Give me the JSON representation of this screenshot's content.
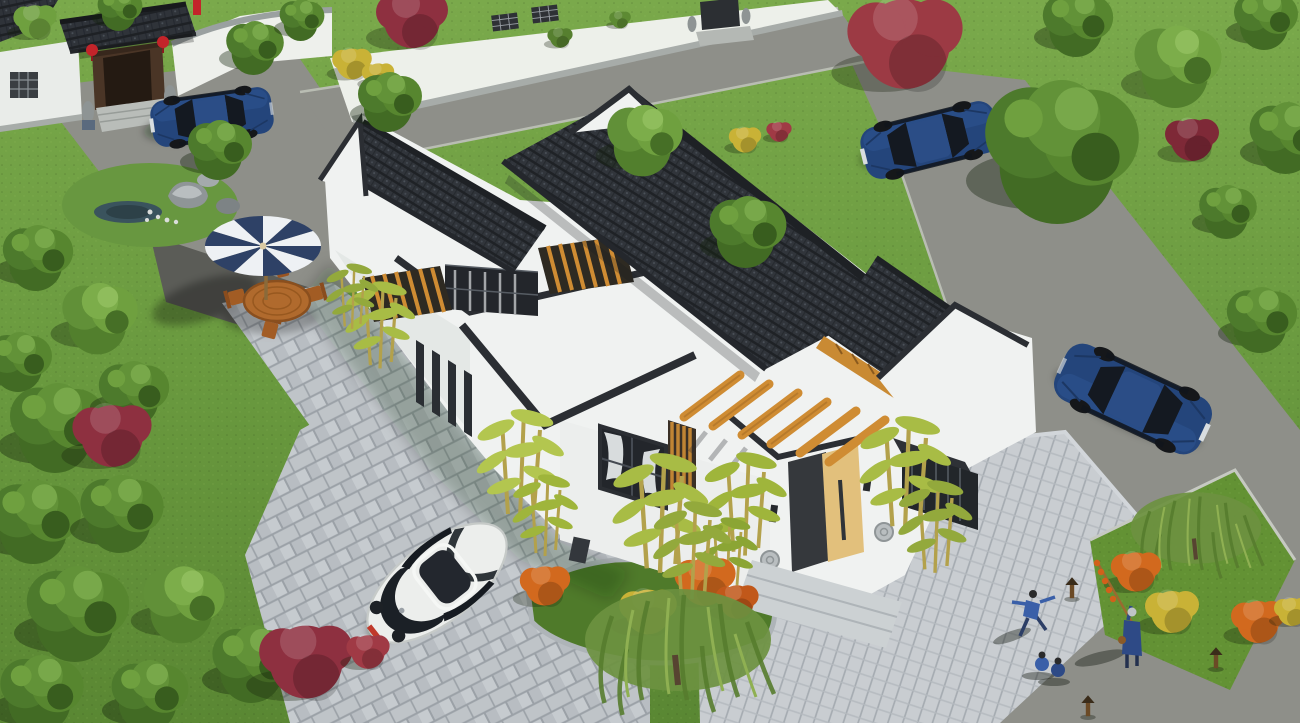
{
  "scene": {
    "type": "3d-architectural-rendering",
    "view": "aerial-isometric",
    "subject": "chinese-style-courtyard-house",
    "setting": "residential compound with lawns, roads, paved courts"
  },
  "palette": {
    "lawn": "#6a9a3f",
    "lawn_dark": "#567f2f",
    "bed": "#4f7a2a",
    "road": "#8e8f89",
    "asphalt": "#5b5c57",
    "paver": "#bcc1c5",
    "paver_light": "#c9cdd0",
    "roof_tile": "#30343a",
    "roof_trim": "#2b2e33",
    "wall": "#f0f2f1",
    "wall_shade": "#e2e6e4",
    "wood": "#c98a33",
    "door": "#e2c07c",
    "stone": "#ccd1d3",
    "water": "#3a535d",
    "umbrella_navy": "#2e4166",
    "umbrella_white": "#eef1f4",
    "car_blue": "#27497f",
    "car_white": "#eceeec",
    "plate_red": "#c0392b",
    "tree": "#4d7a2c",
    "tree_light": "#6fa03f",
    "foliage_red": "#8e3040",
    "foliage_red2": "#9c3a44",
    "flower_orange": "#d2691e",
    "flower_yellow": "#c9b236",
    "lantern_red": "#c3242a",
    "clothing_blue": "#3a5fa8",
    "clothing_navy": "#2e4a86"
  },
  "objects": {
    "main_house": {
      "style": "modern-chinese-courtyard",
      "roof": "dark-grey-tile-gable",
      "walls": "white",
      "accents": "timber-pergola-beams",
      "door": "light-timber",
      "features": [
        "flat-roof-sections",
        "curtained-window",
        "timber-slat-screen",
        "lattice-courtyard-windows",
        "stone-drum-doorsteps",
        "bamboo-planting"
      ]
    },
    "gatehouse": {
      "style": "traditional-gate",
      "features": [
        "dark-tile-roof",
        "red-lanterns",
        "timber-doors",
        "stone-lions",
        "stone-steps"
      ]
    },
    "patio": {
      "umbrella": "navy-white-striped",
      "furniture": "timber-oval-table-with-4-chairs"
    },
    "cars": [
      {
        "type": "sedan",
        "color": "blue",
        "location": "gate-driveway"
      },
      {
        "type": "sedan",
        "color": "blue",
        "location": "upper-road-by-tree"
      },
      {
        "type": "sedan",
        "color": "blue",
        "location": "right-road"
      },
      {
        "type": "beetle-coupe",
        "color": "white",
        "plate_color": "red",
        "location": "front-court"
      }
    ],
    "people": [
      {
        "pose": "tai-chi",
        "clothing": "blue",
        "location": "right-court"
      },
      {
        "pose": "sitting",
        "count": 2,
        "clothing": "blue",
        "location": "right-court"
      },
      {
        "pose": "standing-with-candied-haw-pole",
        "clothing": "navy",
        "location": "right-lawn-edge"
      }
    ],
    "landscape": {
      "rock_garden_with_pond": true,
      "willow_trees": 2,
      "bamboo_clumps": 7,
      "flower_bush_colors": [
        "orange",
        "yellow",
        "red"
      ],
      "red_foliage_trees": 4,
      "garden_lamps": 3
    }
  }
}
